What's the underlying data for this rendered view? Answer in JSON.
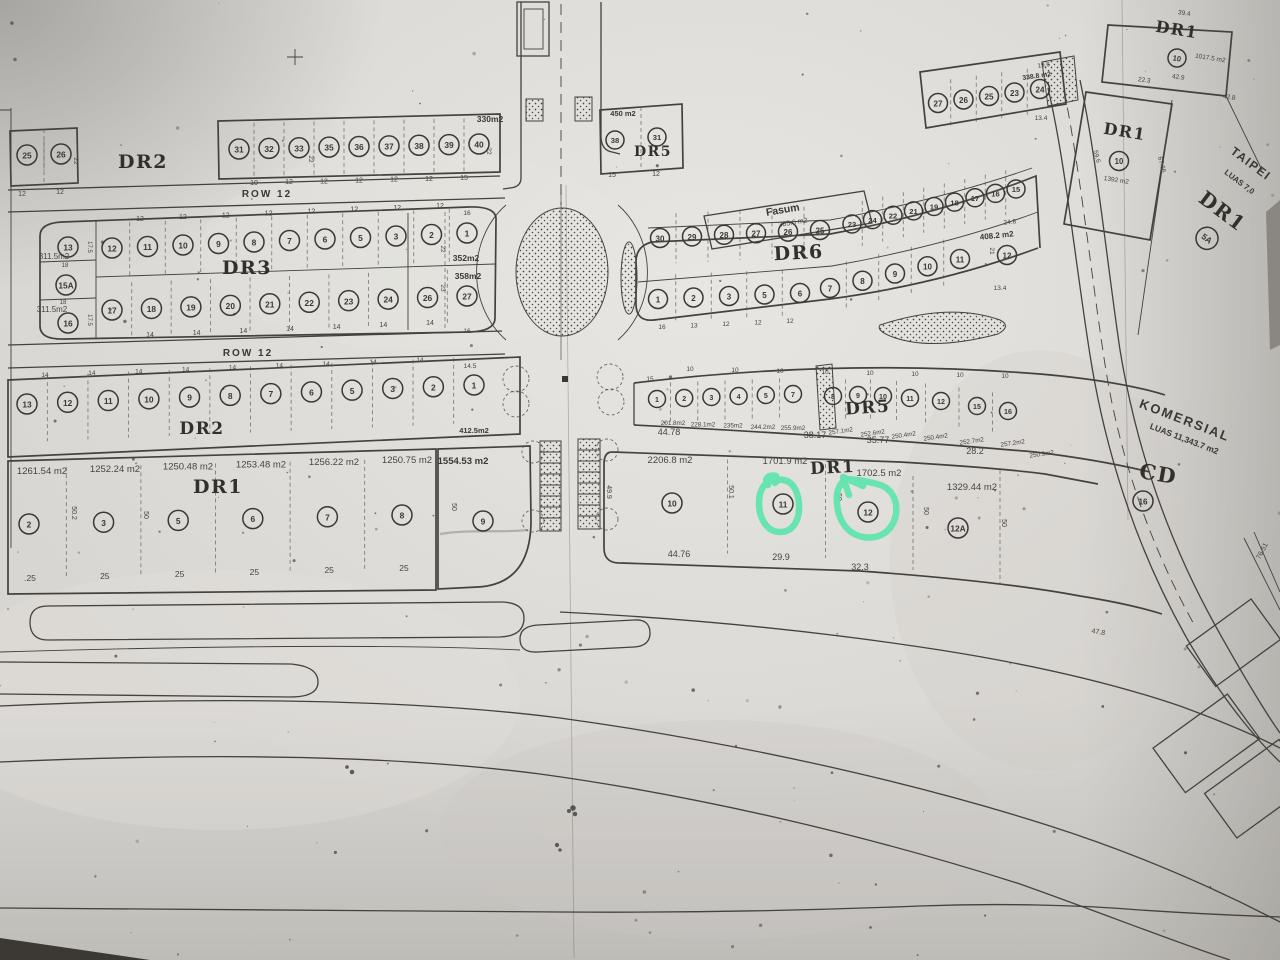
{
  "doc": {
    "kind": "land subdivision site plan (photocopied blueprint, photographed)"
  },
  "row12_top": "ROW 12",
  "row12_mid": "ROW 12",
  "blocks": {
    "dr2_top": {
      "name": "DR2",
      "lots_left": [
        "25",
        "26"
      ],
      "ticks_left": [
        "12",
        "12"
      ],
      "side_dim": "22",
      "strip_lots": [
        "31",
        "32",
        "33",
        "35",
        "36",
        "37",
        "38",
        "39",
        "40"
      ],
      "strip_ticks": [
        "10",
        "12",
        "12",
        "12",
        "12",
        "12",
        "15"
      ],
      "strip_side_dims": [
        "22",
        "22"
      ],
      "area": "330m2"
    },
    "dr5_top": {
      "name": "DR5",
      "area": "450 m2",
      "lots": [
        "38",
        "31"
      ],
      "ticks": [
        "15",
        "12"
      ]
    },
    "fasum": {
      "name": "Fasum",
      "area": "305.6 m2"
    },
    "strip_tr": {
      "lots": [
        "27",
        "26",
        "25",
        "23",
        "24"
      ],
      "area": "338.8 m2",
      "dim_a": "19.6",
      "dim_b": "13.4"
    },
    "dr1_tr_a": {
      "name": "DR1",
      "lot": "10",
      "area": "1017.5 m2",
      "dims": [
        "39.4",
        "42.9",
        "22.3",
        "42.8"
      ]
    },
    "dr1_tr_b": {
      "name": "DR1",
      "lot": "10",
      "area": "1392 m2",
      "dims": [
        "59.6",
        "67.66"
      ]
    },
    "taipei": {
      "name_a": "TAIPEI",
      "name_b": "LUAS 7,0",
      "name_c": "DR1",
      "lot": "5A"
    },
    "dr3": {
      "name": "DR3",
      "left_lots": [
        "13",
        "15A",
        "16"
      ],
      "left_areas": [
        "311.5m2",
        "311.5m2"
      ],
      "left_dims": [
        "18",
        "18",
        "17.5",
        "17.5"
      ],
      "top_row": [
        "12",
        "11",
        "10",
        "9",
        "8",
        "7",
        "6",
        "5",
        "3",
        "2",
        "1"
      ],
      "top_ticks": "12",
      "bottom_row": [
        "17",
        "18",
        "19",
        "20",
        "21",
        "22",
        "23",
        "24",
        "26",
        "27"
      ],
      "bottom_ticks": "14",
      "right_areas": [
        "352m2",
        "358m2"
      ],
      "right_dims": [
        "16",
        "22",
        "23",
        "16"
      ]
    },
    "dr6": {
      "name": "DR6",
      "top_row_a": [
        "30",
        "29",
        "28",
        "27",
        "26",
        "25"
      ],
      "top_row_b": [
        "23",
        "24",
        "22",
        "21",
        "19",
        "18",
        "17",
        "16",
        "15"
      ],
      "right_lot": "12",
      "right_dim": "21",
      "bottom_row_a": [
        "1",
        "2",
        "3",
        "5",
        "6"
      ],
      "bottom_row_b": [
        "7",
        "8",
        "9",
        "10",
        "11"
      ],
      "bottom_ticks": [
        "16",
        "13",
        "12",
        "12",
        "12"
      ],
      "area": "408.2 m2",
      "dim_a": "24.8",
      "dim_b": "13.4"
    },
    "dr2_mid": {
      "name": "DR2",
      "lots": [
        "13",
        "12",
        "11",
        "10",
        "9",
        "8",
        "7",
        "6",
        "5",
        "3",
        "2",
        "1"
      ],
      "area": "412.5m2",
      "top_tick": "14",
      "top_tick_last": "14.5"
    },
    "dr5_mid": {
      "name": "DR5",
      "lots_a": [
        "1",
        "2",
        "3",
        "4",
        "5",
        "7"
      ],
      "lots_b": [
        "8",
        "9",
        "10",
        "11",
        "12",
        "15",
        "16"
      ],
      "areas_a": [
        "201.8m2",
        "228.1m2",
        "235m2",
        "244.2m2",
        "255.9m2"
      ],
      "areas_b": [
        "257.1m2",
        "252.6m2",
        "250.4m2",
        "250.4m2",
        "252.7m2",
        "257.2m2",
        "250.9m2"
      ],
      "tick_first": "15",
      "tick": "10"
    },
    "dr1_left": {
      "name": "DR1",
      "lots": [
        "2",
        "3",
        "5",
        "6",
        "7",
        "8"
      ],
      "areas": [
        "1261.54 m2",
        "1252.24 m2",
        "1250.48 m2",
        "1253.48 m2",
        "1256.22 m2",
        "1250.75 m2"
      ],
      "bottom_ticks": [
        ".25",
        "25",
        "25",
        "25",
        "25",
        "25"
      ],
      "dims_v": [
        "50.2",
        "50"
      ],
      "lot9": "9",
      "area9": "1554.53 m2",
      "dim9": "50"
    },
    "dr1_mid": {
      "name": "DR1",
      "lots": [
        "10",
        "11",
        "12",
        "12A"
      ],
      "areas": [
        "2206.8 m2",
        "1701.9 m2",
        "1702.5 m2",
        "1329.44 m2"
      ],
      "dims_top": [
        "44.78",
        "38.17",
        "35.77",
        "28.2"
      ],
      "dims_bottom": [
        "44.76",
        "29.9",
        "32.3"
      ],
      "dims_v": [
        "49.9",
        "50.1",
        "50",
        "50",
        "50"
      ]
    },
    "komersial": {
      "name_a": "KOMERSIAL",
      "name_b": "LUAS 11,343.7 m2",
      "name_c": "CD",
      "lot": "16"
    }
  },
  "misc_dims": {
    "road_a": "47.8",
    "road_b": "76.51"
  },
  "highlight": {
    "color": "#5fe5ad",
    "circled_lots": [
      "11",
      "12"
    ]
  }
}
